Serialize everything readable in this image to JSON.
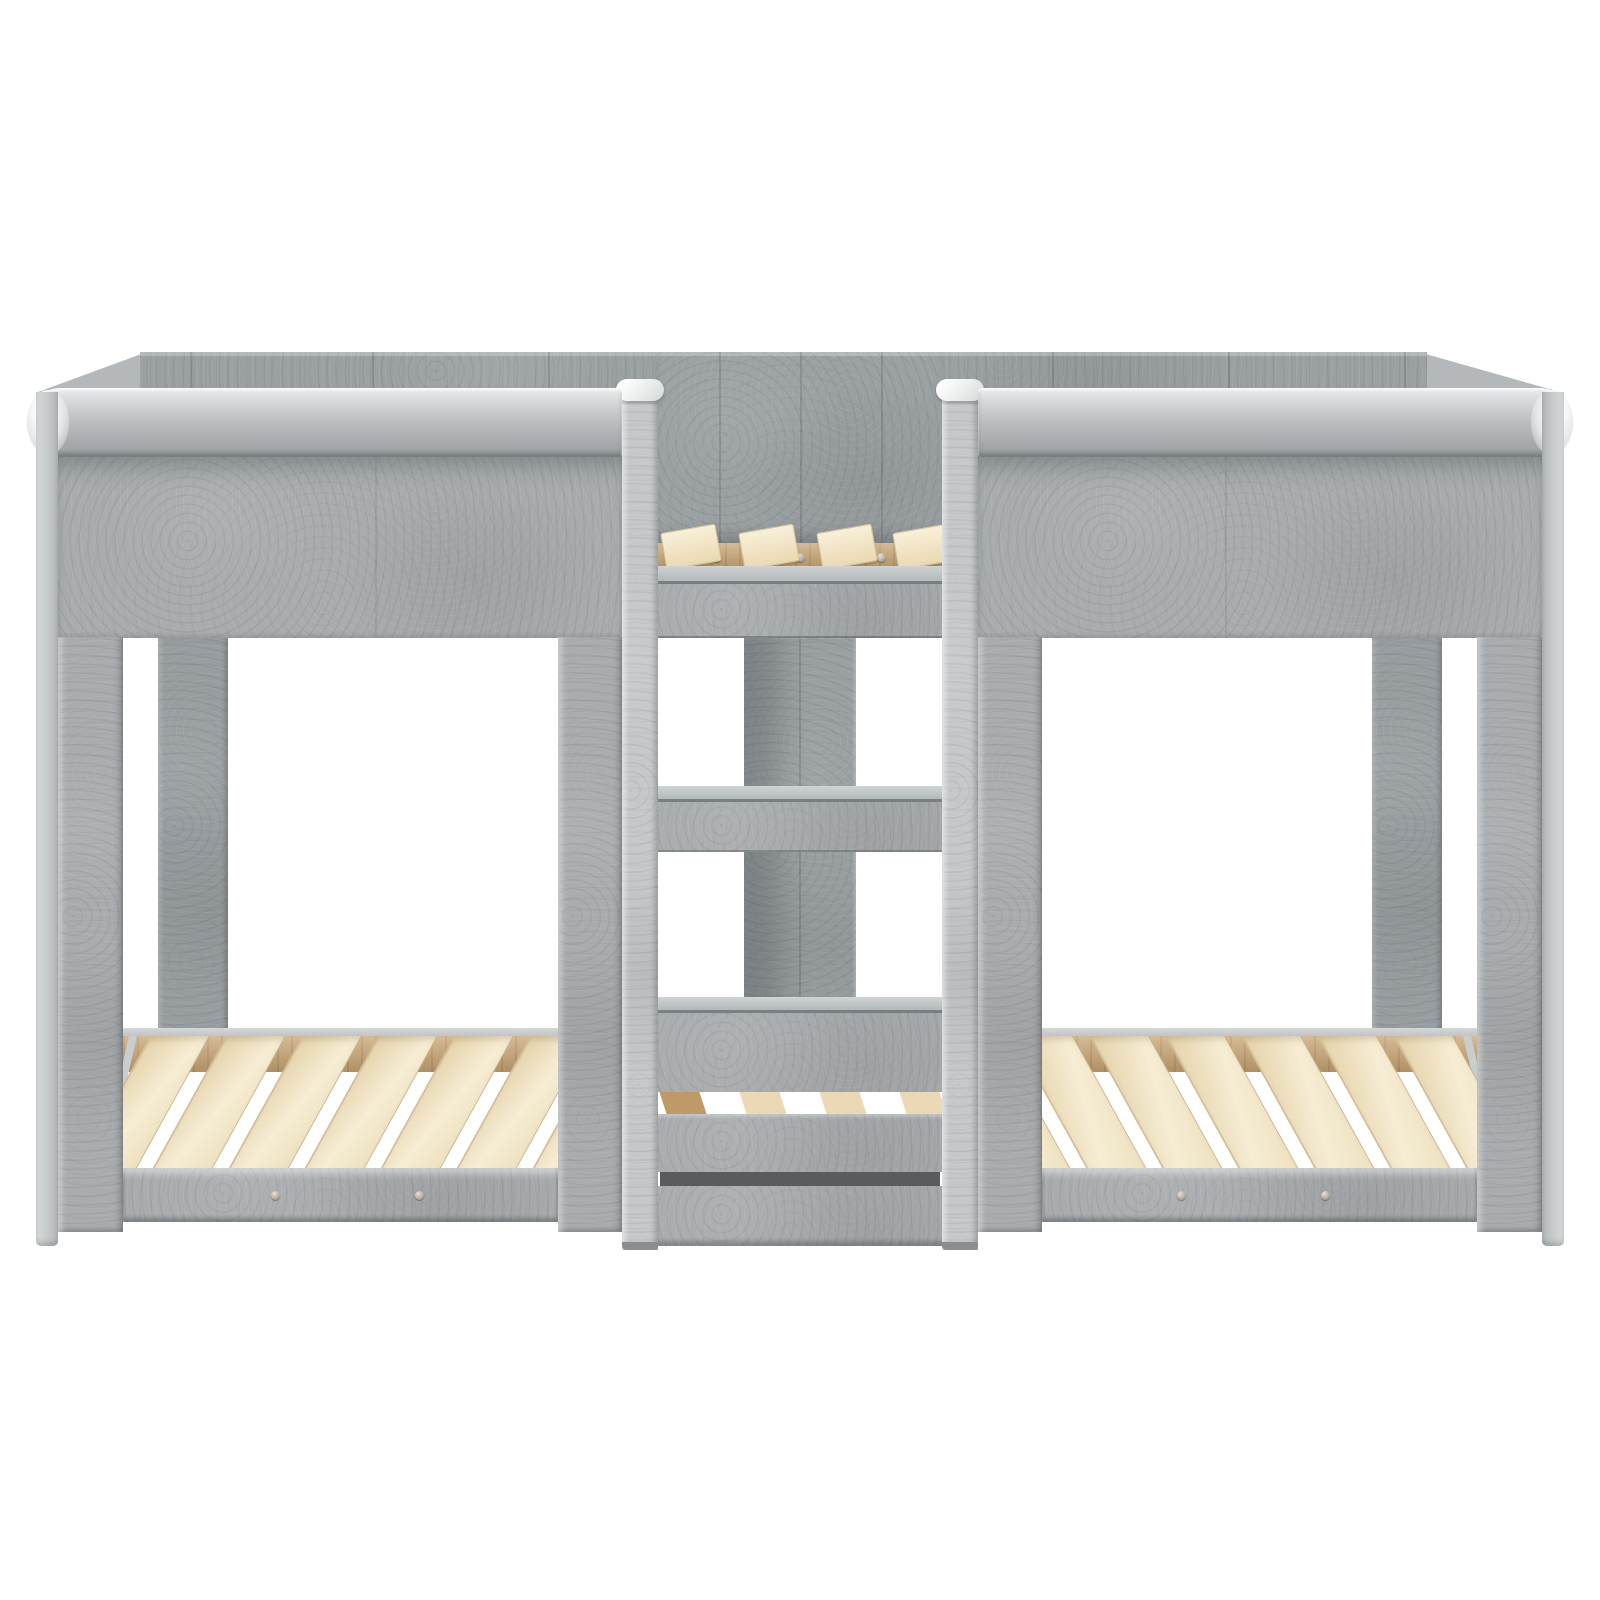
{
  "scene": {
    "type": "product-photo",
    "object": "Twin low bunk beds with central ladder",
    "description": "Front-on studio photograph of a concrete-grey engineered-wood bed unit: two identical low single bed frames joined by a central three-rung ladder tower, with pale wooden bed slats, on a plain white background.",
    "material_finish": "concrete grey wood-effect",
    "view": "front elevation",
    "background": "#ffffff"
  },
  "palette": {
    "bg": "#ffffff",
    "concrete_mid": "#a8acae",
    "concrete_light": "#c5c8c9",
    "concrete_dark": "#989da0",
    "concrete_back_wall": "#9ba0a2",
    "shadow_slot": "#585c5f",
    "slat_cream": "#ead9b4",
    "slat_tan": "#c09a66",
    "wood_rail_tan": "#c8a472",
    "cap_white": "#fdfdfd"
  },
  "structure": {
    "beds": {
      "count": 2,
      "slats_per_bed": 7,
      "front_legs_per_bed": 2,
      "visible_back_legs_per_bed": 1,
      "guard_rail_per_bed": 1,
      "screws_per_front_rail": 2,
      "screws_per_wood_rail": 2
    },
    "ladder": {
      "posts": 2,
      "rungs": 3,
      "top_platform_slats": 4,
      "wood_rail_screws": 3,
      "slit_segments": [
        "tan",
        "cream",
        "cream",
        "cream"
      ],
      "center_post": 1
    },
    "back_wall": {
      "plank_seams_wide": 6,
      "plank_seams_center": 3
    }
  }
}
